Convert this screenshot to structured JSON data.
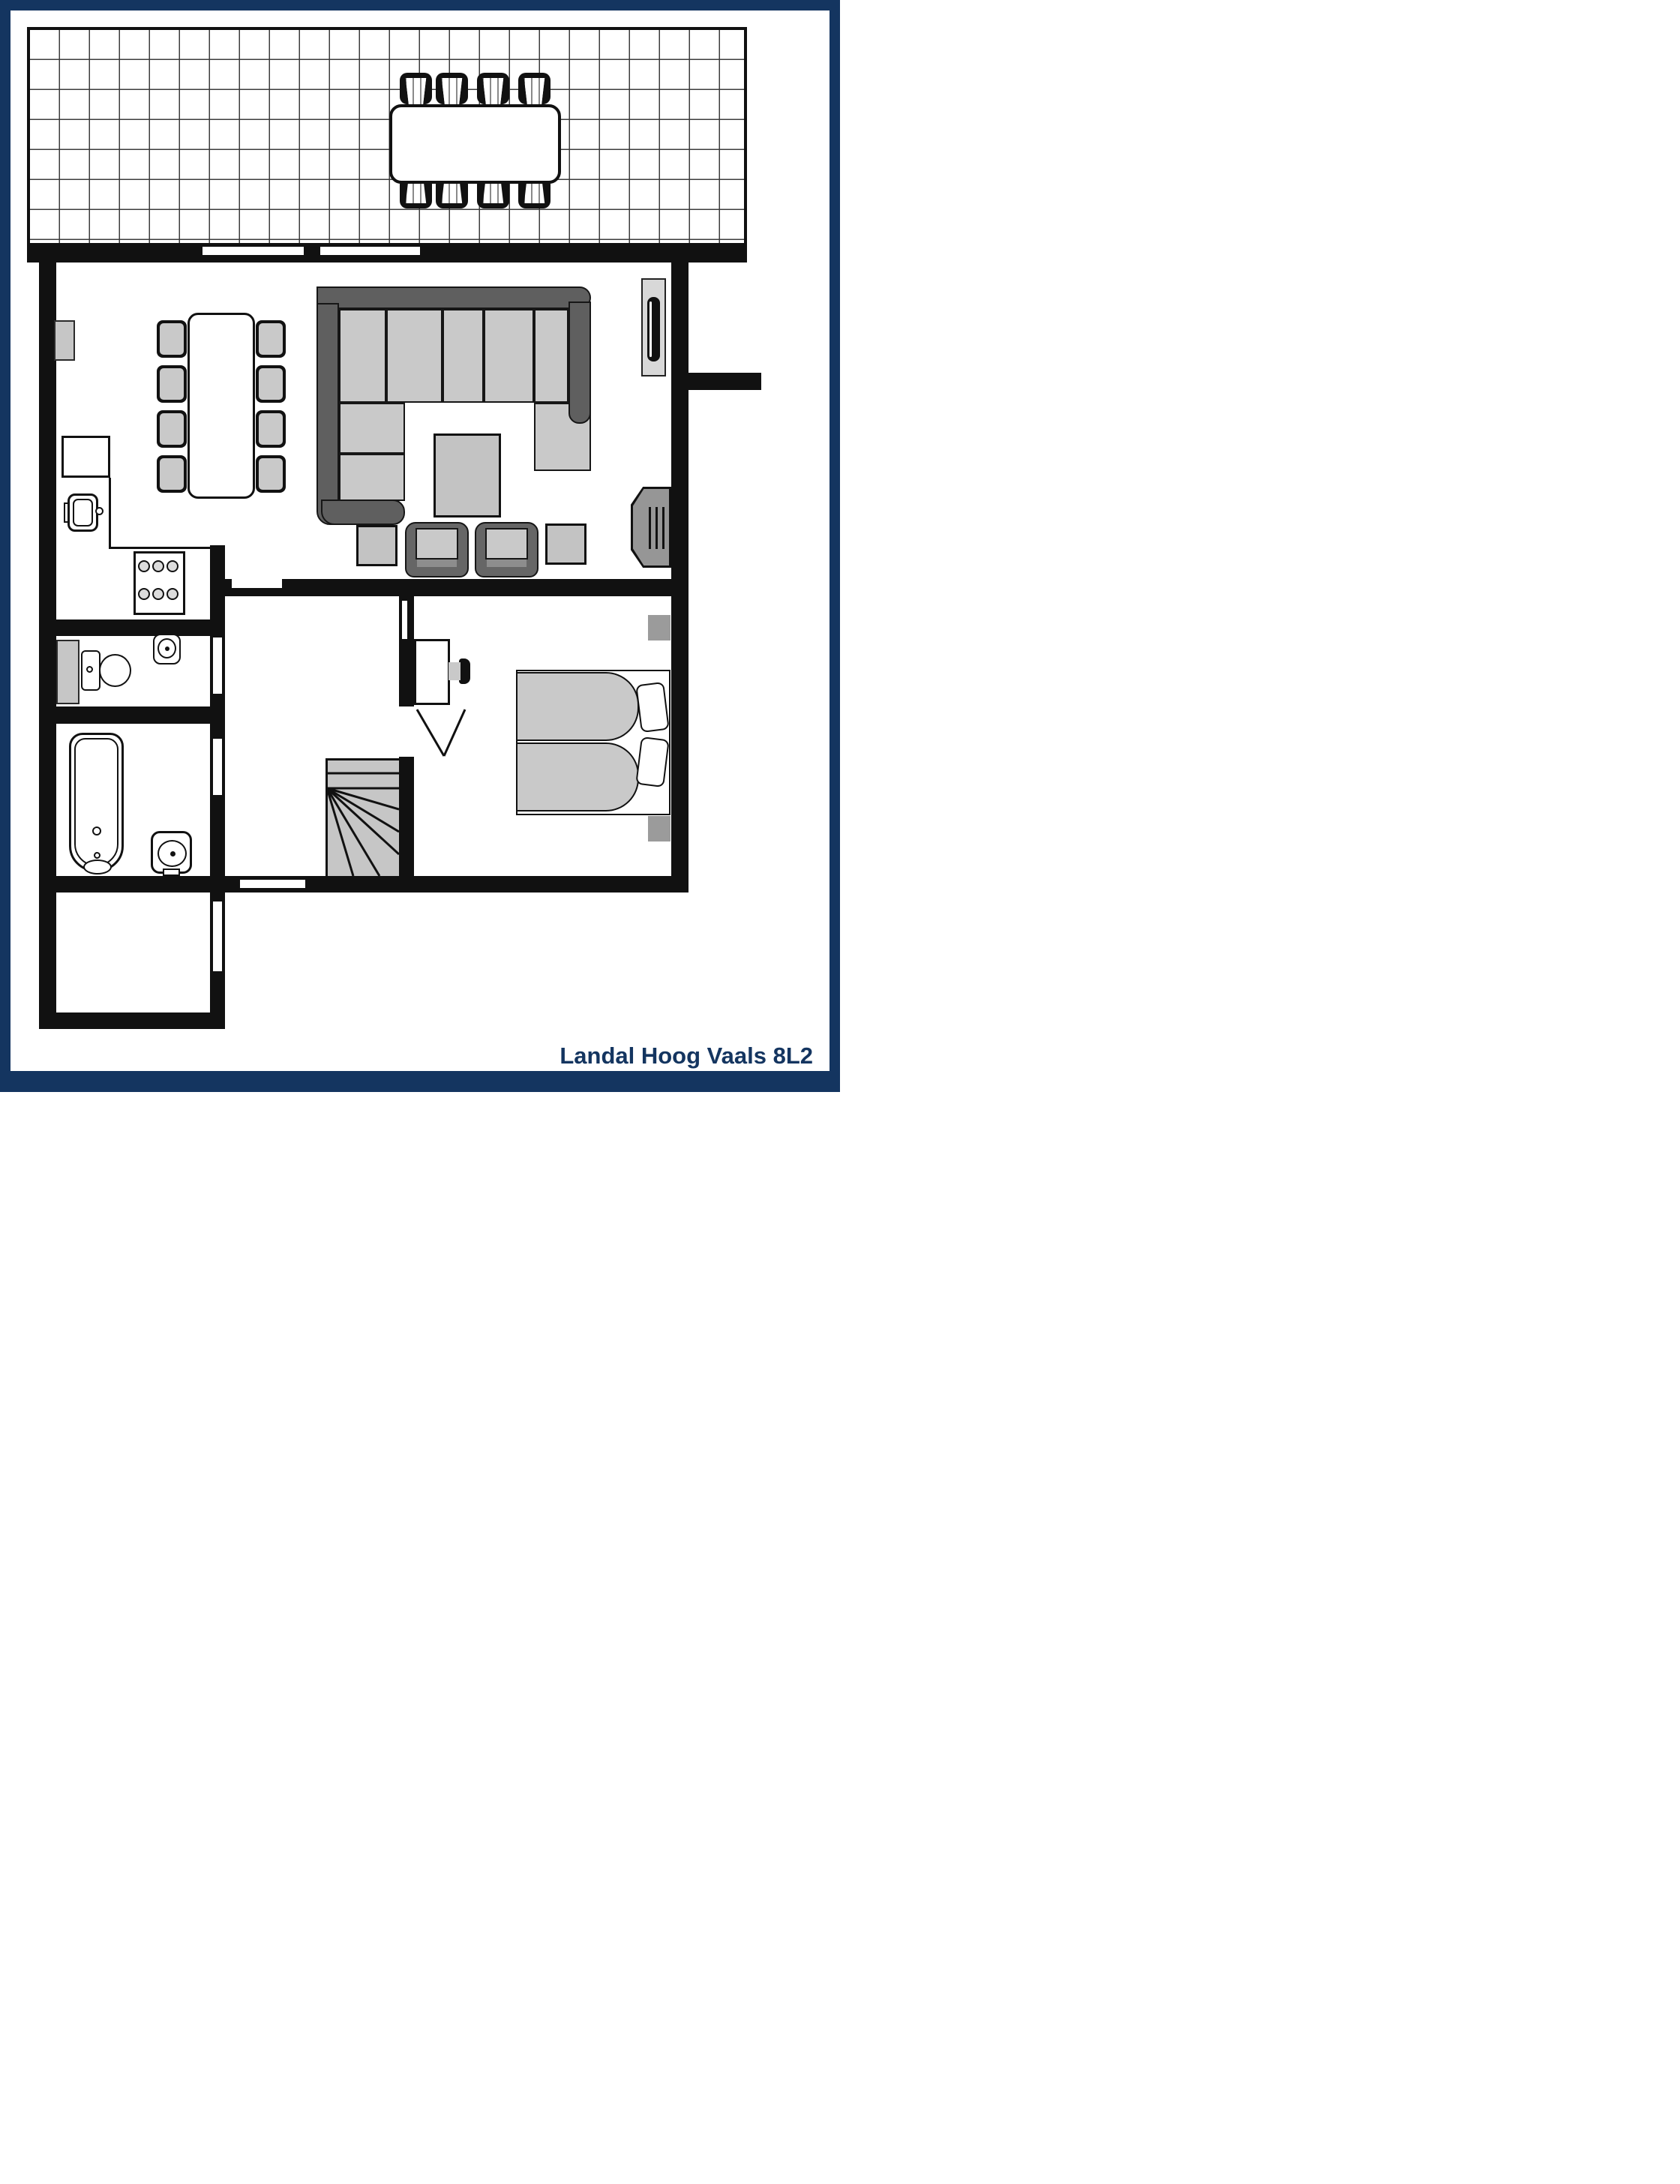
{
  "caption": "Landal Hoog Vaals 8L2",
  "colors": {
    "navy": "#143560",
    "wall_black": "#111111",
    "furniture_light_gray": "#c9c9c9",
    "furniture_mid_gray": "#969696",
    "sofa_dark_gray": "#5f5f5f",
    "table_gray": "#c3c3c3"
  },
  "icons": [
    "terrace-dining-table",
    "terrace-chair",
    "corner-sofa",
    "coffee-table",
    "armchair",
    "side-table",
    "fireplace",
    "tv",
    "dining-table",
    "dining-chair",
    "radiator",
    "kitchen-counter",
    "kitchen-sink",
    "stove",
    "toilet",
    "washbasin",
    "bathtub",
    "winder-staircase",
    "double-bed",
    "pillow",
    "nightstand",
    "desk",
    "desk-chair"
  ]
}
